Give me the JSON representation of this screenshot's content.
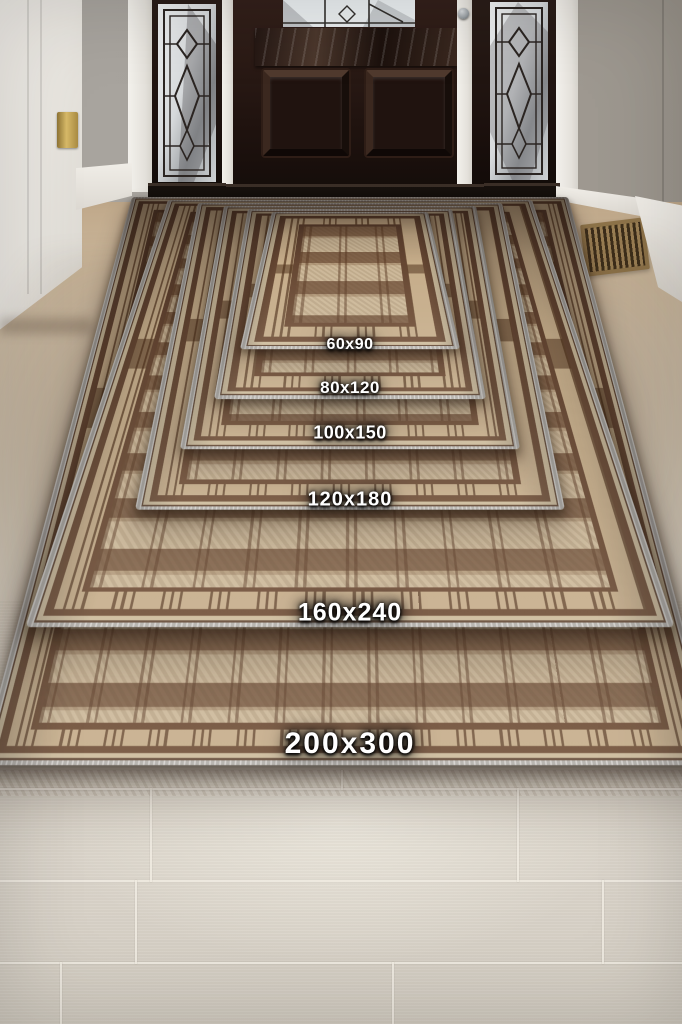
{
  "rugs": [
    {
      "label": "60x90"
    },
    {
      "label": "80x120"
    },
    {
      "label": "100x150"
    },
    {
      "label": "120x180"
    },
    {
      "label": "160x240"
    },
    {
      "label": "200x300"
    }
  ],
  "palette": {
    "rug_tan": "#c8b393",
    "rug_brown": "#6b4a33",
    "binding_gray": "#b8b4ae",
    "front_door_brown": "#2a1a14",
    "wall_gray": "#a6a29c",
    "floor_tan_near_door": "#c1aa8c",
    "floor_light_tile": "#d9d1c3",
    "vent_bronze": "#8f744a",
    "label_text": "#ffffff"
  }
}
